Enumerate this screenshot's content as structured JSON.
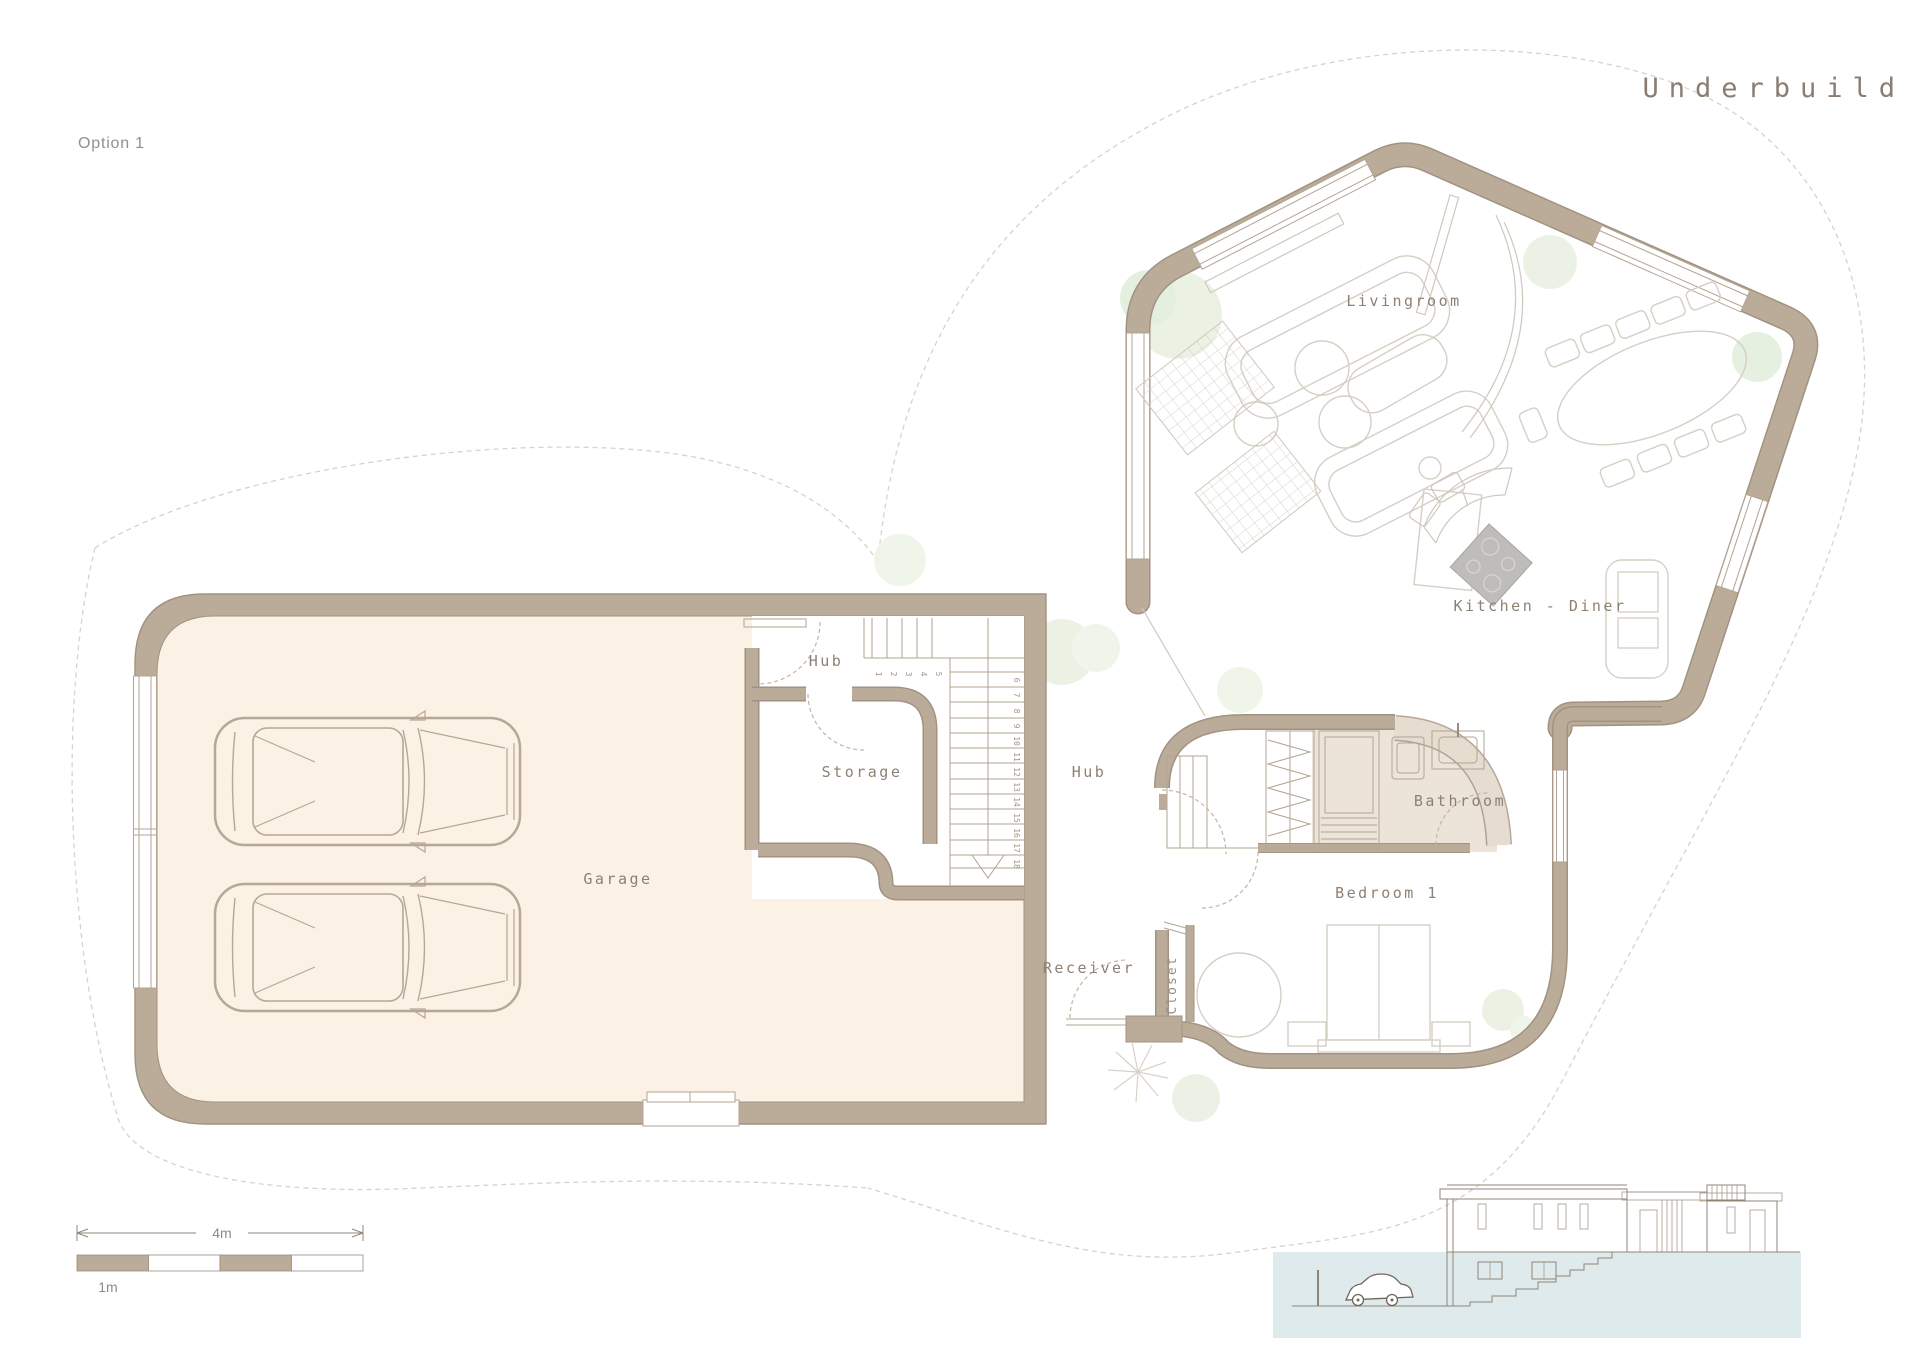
{
  "page": {
    "title": "Underbuild",
    "option": "Option 1"
  },
  "plan": {
    "rooms": {
      "livingroom": "Livingroom",
      "kitchen_diner": "Kitchen - Diner",
      "hub_upper": "Hub",
      "storage": "Storage",
      "garage": "Garage",
      "hub_lower": "Hub",
      "receiver": "Receiver",
      "closet": "Closet",
      "bedroom1": "Bedroom 1",
      "bathroom": "Bathroom"
    },
    "stairs": {
      "numbers": [
        "1",
        "2",
        "3",
        "4",
        "5",
        "6",
        "7",
        "8",
        "9",
        "10",
        "11",
        "12",
        "13",
        "14",
        "15",
        "16",
        "17",
        "18"
      ]
    }
  },
  "scale_bar": {
    "total": "4m",
    "unit": "1m"
  },
  "colors": {
    "wall": "#bbac9a",
    "wall_edge": "#a29281",
    "garage_floor": "#fbf1e4",
    "bath_floor": "#ece3d9",
    "tree": "#e9f1e2",
    "underground": "#dfeaed",
    "label": "#8e8173",
    "boundary_dash": "#d9d2c7"
  }
}
